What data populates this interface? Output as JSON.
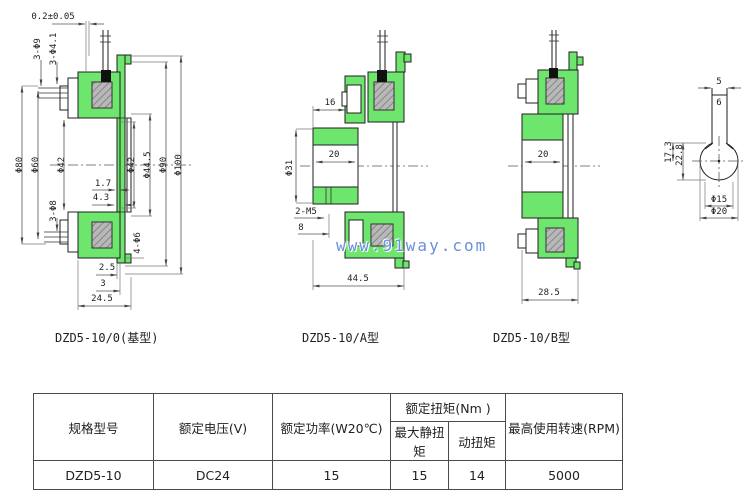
{
  "watermark": {
    "text": "www.91way.com"
  },
  "views": {
    "base": {
      "label": "DZD5-10/0(基型)",
      "dims": {
        "gap": "0.2±0.05",
        "holes_top_outer": "3-Φ9",
        "holes_top_inner": "3-Φ4.1",
        "phi_80": "Φ80",
        "phi_60": "Φ60",
        "phi_42_left": "Φ42",
        "phi_42_right": "Φ42",
        "phi_44_5": "Φ44.5",
        "phi_90": "Φ90",
        "phi_100": "Φ100",
        "d_1_7": "1.7",
        "d_4_3": "4.3",
        "holes_bottom": "3-Φ8",
        "holes_flange": "4-Φ6",
        "d_2_5": "2.5",
        "d_3": "3",
        "d_24_5": "24.5"
      }
    },
    "type_a": {
      "label": "DZD5-10/A型",
      "dims": {
        "d_16": "16",
        "d_20": "20",
        "phi_31": "Φ31",
        "holes_m5": "2-M5",
        "d_8": "8",
        "d_44_5": "44.5"
      }
    },
    "type_b": {
      "label": "DZD5-10/B型",
      "dims": {
        "d_20": "20",
        "d_28_5": "28.5"
      }
    },
    "end_view": {
      "dims": {
        "d_5": "5",
        "d_6": "6",
        "d_17_3": "17.3",
        "d_22_8": "22.8",
        "phi_15": "Φ15",
        "phi_20": "Φ20"
      }
    }
  },
  "spec_table": {
    "headers": {
      "model": "规格型号",
      "voltage": "额定电压(V)",
      "power": "额定功率(W20℃)",
      "torque_group": "额定扭矩(Nm )",
      "static_torque": "最大静扭矩",
      "dynamic_torque": "动扭矩",
      "max_speed": "最高使用转速(RPM)"
    },
    "row": {
      "model": "DZD5-10",
      "voltage": "DC24",
      "power": "15",
      "static_torque": "15",
      "dynamic_torque": "14",
      "max_speed": "5000"
    }
  },
  "colors": {
    "body_green": "#6ee66e",
    "coil_gray": "#b8b8b8",
    "watermark_blue": "#6b8fd8"
  }
}
